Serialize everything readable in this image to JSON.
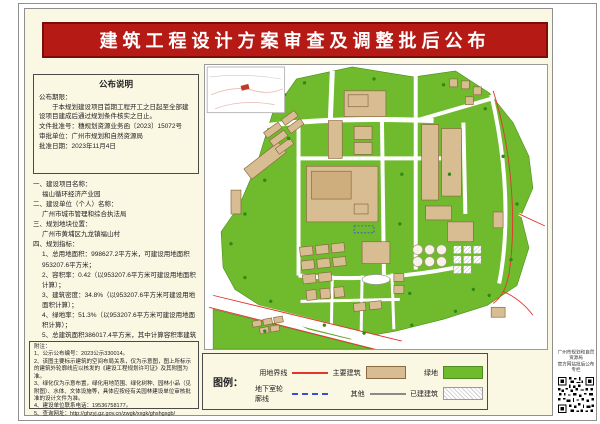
{
  "banner": {
    "title": "建筑工程设计方案审查及调整批后公布"
  },
  "notice_box": {
    "title": "公布说明",
    "period_label": "公布期限：",
    "period_text": "于本规划建设项目首期工程开工之日起至全部建设项目建成后通过规划条件核实之日止。",
    "doc_no": "文件批准号：穗规划资源业务函〔2023〕15072号",
    "approver": "审批单位：广州市规划和自然资源局",
    "date": "批准日期：2023年11月4日"
  },
  "sections": [
    {
      "heading": "一、建设项目名称：",
      "body": "福山循环经济产业园"
    },
    {
      "heading": "二、建设单位（个人）名称：",
      "body": "广州市城市管理和综合执法局"
    },
    {
      "heading": "三、规划地块位置：",
      "body": "广州市黄埔区九龙镇福山村"
    },
    {
      "heading": "四、规划指标：",
      "items": [
        "1、总用地面积：998627.2平方米，可建设用地面积953207.6平方米；",
        "2、容积率：0.42（以953207.6平方米可建设用地面积计算）；",
        "3、建筑密度：34.8%（以953207.6平方米可建设用地面积计算）；",
        "4、绿地率：51.3%（以953207.6平方米可建设用地面积计算）；",
        "5、总建筑面积386017.4平方米，其中计算容积率建筑面积395818平方米。"
      ]
    },
    {
      "heading": "五、车位配置情况：",
      "body": "地上机动车泊车位：466个。"
    },
    {
      "heading": "六、批文主要内容详见穗规划资源业务函〔2021〕10950号文及相应附图。",
      "body": ""
    }
  ],
  "notes": {
    "title": "附注：",
    "items": [
      "1、公示公布编号：2023公示330014。",
      "2、该图主要标示建筑的空间布局关系，仅为示意图，图上所标示的建筑外轮廓线应以核发的《建设工程规划许可证》及其附图为准。",
      "3、绿化仅为示意布置，绿化用地范围、绿化树种、园林小品（见附图）、水体、文体设施等，具体应按经有关园林建设单位审核批准的设计文件为准。",
      "4、建设单位联系电话：19536758177。",
      "5、查询网址：http://ghzyj.gz.gov.cn/zwgk/xxgk/ghshgsgb/"
    ]
  },
  "map": {
    "scale_label": "比例尺：1:8000",
    "plan_label": "总平面示意图"
  },
  "legend": {
    "title": "图例：",
    "items": [
      {
        "label": "用地界线"
      },
      {
        "label": "主要建筑"
      },
      {
        "label": "绿地"
      },
      {
        "label": "地下室轮廓线"
      },
      {
        "label": "其他"
      },
      {
        "label": "已建建筑"
      }
    ]
  },
  "qr": {
    "caption_line1": "广州市规划和自然资源局",
    "caption_line2": "官方网站批后公布专栏"
  },
  "colors": {
    "banner_red": "#b51a15",
    "green_area": "#6fbb2d",
    "building_tan": "#d9bd92",
    "boundary_red": "#e3342f",
    "basement_blue": "#3a4fd8",
    "paper_cream": "#faf7e3"
  }
}
